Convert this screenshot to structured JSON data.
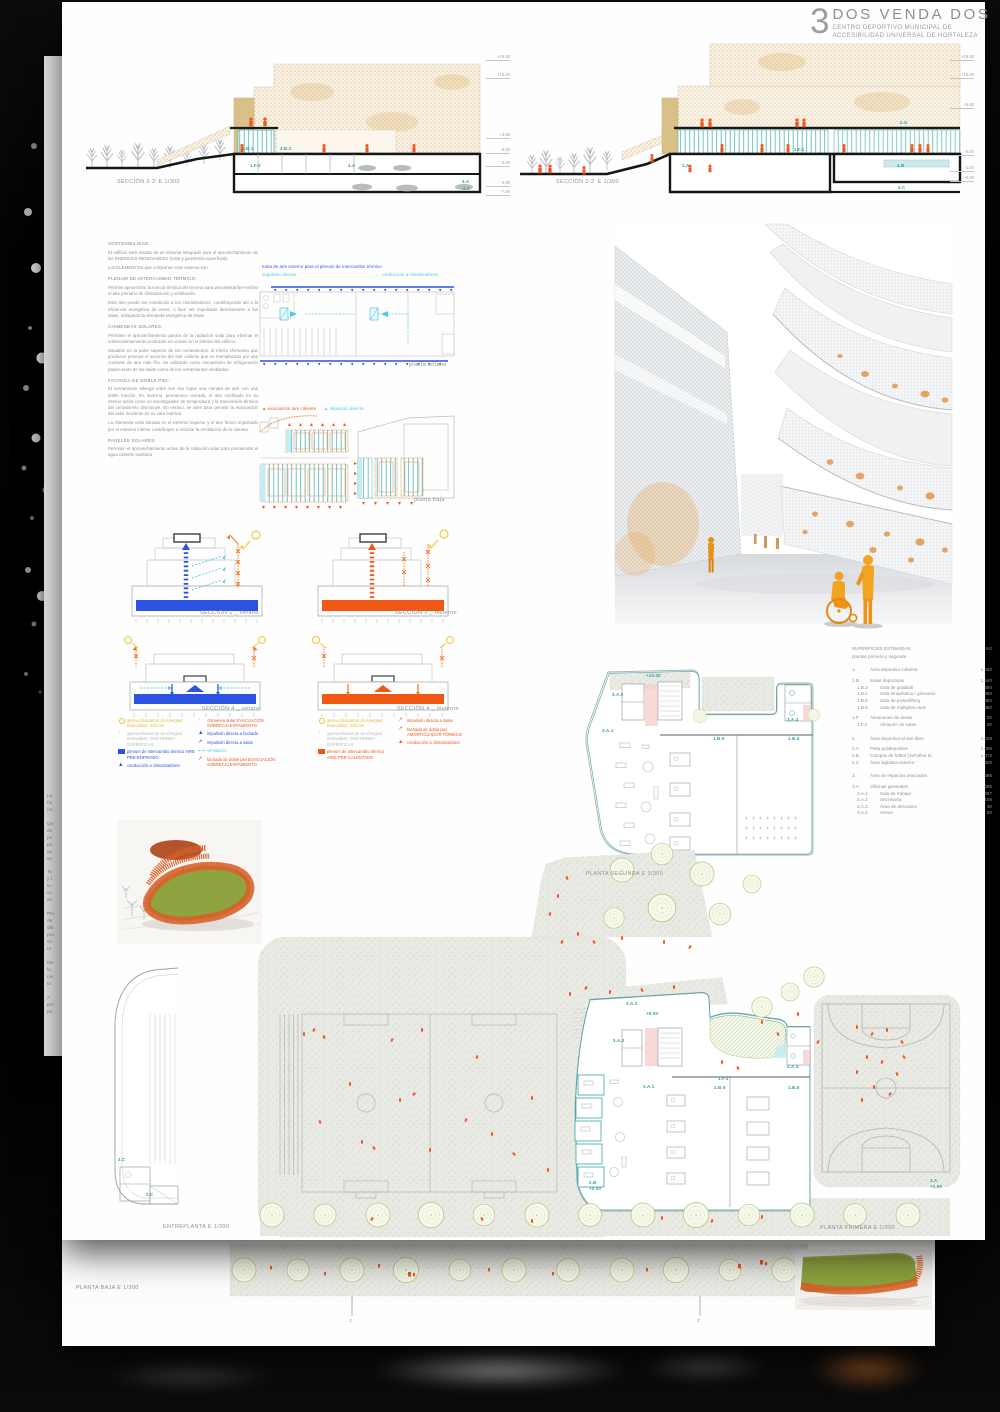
{
  "colors": {
    "teal": "#2f9fa0",
    "orange": "#f0561c",
    "blue": "#2b52e0",
    "cyan": "#4ec9de",
    "yellow": "#f2c230",
    "winter_orange": "#f05714",
    "model_green": "#8da23f",
    "model_orange": "#e0622a"
  },
  "title": {
    "number": "3",
    "name": "DOS VENDA DOS",
    "line1": "CENTRO DEPORTIVO MUNICIPAL DE",
    "line2": "ACCESIBILIDAD UNIVERSAL DE HORTALEZA"
  },
  "top_sections": {
    "left_label": "SECCIÓN 3-3' E 1/300",
    "right_label": "SECCIÓN 2-2' E 1/300",
    "mid_levels": [
      "+19.50",
      "+15.20",
      "+3.50",
      "-0.00",
      "-3.00",
      "-4.00",
      "-7.00"
    ],
    "right_levels": [
      "+19.50",
      "+15.00",
      "+5.60",
      "-0.00",
      "-1.00",
      "-5.00"
    ],
    "tags_left": {
      "b1": "3.B.1",
      "b2": "3.B.2",
      "f3": "1.F.3",
      "a1": "4.A",
      "a2": "4.A",
      "c": "4.C"
    },
    "tags_right": {
      "g": "2.G",
      "f1": "1.F.1",
      "a": "1.A",
      "b": "4.B",
      "c": "4.C"
    }
  },
  "sustainability": {
    "paragraphs": [
      {
        "t": "SOSTENIBILIDAD"
      },
      {
        "t": "El edificio está dotado de un sistema integrado para el aprovechamiento de las ENERGÍAS RENOVABLES (solar y geotermia superficial)."
      },
      {
        "t": "Los ELEMENTOS que componen este sistema son"
      },
      {
        "t": "PLENUM DE INTERCAMBIO TÉRMICO:"
      },
      {
        "t": "Permite aprovechar la inercia térmica del terreno para precalentar/pre-enfriar el aire primario de climatización y ventilación."
      },
      {
        "t": "Este aire puede ser conducido a los climatizadores, contribuyendo así a la eficiencia energética de estos, o bien ser impulsado directamente a las salas, rebajando la demanda energética de éstas."
      },
      {
        "t": "CHIMENEAS SOLARES:"
      },
      {
        "t": "Permiten el aprovechamiento pasivo de la radiación solar para eliminar el sobrecalentamiento producido en verano en el interior del edificio."
      },
      {
        "t": "Situados en la parte superior de los cerramientos, el efecto chimenea que producen provoca el ascenso del aire caliente que es reemplazado por una corriente de aire más fría. Se utilizarán como mecanismo de refrigeración pasiva tanto de las salas como de los cerramientos ventilados."
      },
      {
        "t": "FACHADA DE DOBLE PIEL:"
      },
      {
        "t": "El cerramiento alberga entre sus dos hojas una cámara de aire con una doble función. En invierno, permanece cerrada, el aire confinado en su interior actúa como un amortiguador de temperatura y la transmisión térmica del cerramiento disminuye. En verano, se abre para permitir la evacuación del calor incidente en su cara externa."
      },
      {
        "t": "La chimenea solar situada en el extremo superior y el aire fresco impulsado por el extremo inferior contribuyen a reforzar la ventilación de la cámara."
      },
      {
        "t": "PANELES SOLARES:"
      },
      {
        "t": "Permiten el aprovechamiento activo de la radiación solar para precalentar el agua caliente sanitaria"
      }
    ]
  },
  "plenum_plan": {
    "note_blue": "toma de aire exterior para el plenum de intercambio térmico",
    "note_cyan_left": "impulsión directa",
    "note_cyan_right": "← conducción a climatizadores",
    "label": "planta sótano"
  },
  "baja_plan": {
    "note_orange": "▲ evacuación aire caliente",
    "note_cyan": "▲ impulsión directa",
    "label": "planta baja"
  },
  "mini_sections": {
    "s1v": "SECCIÓN 1 _ verano",
    "s1i": "SECCIÓN 1 _ invierno",
    "s4v": "SECCIÓN 4 _ verano",
    "s4i": "SECCIÓN 4 _ invierno"
  },
  "legends": {
    "summer_a": [
      {
        "icon": "sun",
        "color": "#f2c230",
        "text": "aprovechamiento de energías renovables: SOLAR"
      },
      {
        "icon": "geo-arrow",
        "color": "#b4b8bc",
        "text": "aprovechamiento de energías renovables: GEOTERMIA SUPERFICIAL"
      },
      {
        "icon": "swatch",
        "color": "#2b52e0",
        "text": "plenum de intercambio térmico AIRE PRE-ENFRIADO"
      },
      {
        "icon": "arrow-up",
        "color": "#2b52e0",
        "text": "conducción a climatizadores"
      }
    ],
    "summer_b": [
      {
        "icon": "chimney",
        "color": "#f2a230",
        "text": "chimenea solar EVACUACIÓN SOBRECALENTAMIENTO"
      },
      {
        "icon": "arrow-up",
        "color": "#2b52e0",
        "text": "impulsión directa a fachada"
      },
      {
        "icon": "arrow-diag",
        "color": "#2b52e0",
        "text": "impulsión directa a salas"
      },
      {
        "icon": "dash",
        "color": "#6fd3e6",
        "text": "ventilación"
      },
      {
        "icon": "arrow-diag",
        "color": "#f0561c",
        "text": "fachada de doble piel EVACUACIÓN SOBRECALENTAMIENTO"
      }
    ],
    "winter_a": [
      {
        "icon": "sun",
        "color": "#f2c230",
        "text": "aprovechamiento de energías renovables: SOLAR"
      },
      {
        "icon": "geo-arrow",
        "color": "#b4b8bc",
        "text": "aprovechamiento de energías renovables: GEOTERMIA SUPERFICIAL"
      },
      {
        "icon": "swatch",
        "color": "#f0561c",
        "text": "plenum de intercambio térmico AIRE PRE-CALENTADO"
      }
    ],
    "winter_b": [
      {
        "icon": "arrow-diag",
        "color": "#f0561c",
        "text": "impulsión directa a salas"
      },
      {
        "icon": "arrow-diag",
        "color": "#f0561c",
        "text": "fachada de doble piel AMORTIGUADOR TÉRMICO"
      },
      {
        "icon": "arrow-up",
        "color": "#f0561c",
        "text": "conducción a climatizadores"
      }
    ]
  },
  "areas_table": {
    "title": "SUPERFICIES ESTIMADAS",
    "unit": "m2",
    "subtitle": "plantas primera y segunda",
    "rows": [
      {
        "code": "1.",
        "name": "Área deportiva cubierta",
        "value": "1.440"
      },
      {
        "code": "1.B",
        "name": "Salas deportivas",
        "value": "1.440"
      },
      {
        "code": "1.B.3",
        "name": "Sala de goalball",
        "value": "360"
      },
      {
        "code": "1.B.4",
        "name": "Sala terapéutica / gimnasio",
        "value": "360"
      },
      {
        "code": "1.B.5",
        "name": "Sala de powerlifting",
        "value": "360"
      },
      {
        "code": "1.B.6",
        "name": "Sala de múltiples usos",
        "value": "360"
      },
      {
        "code": "1.F",
        "name": "Almacenes de áreas",
        "value": "20"
      },
      {
        "code": "1.F.3",
        "name": "Almacén de salas",
        "value": "20"
      },
      {
        "code": "2.",
        "name": "Área deportiva al aire libre",
        "value": "3.028"
      },
      {
        "code": "2.A",
        "name": "Pista polideportiva",
        "value": "1.056"
      },
      {
        "code": "2.B",
        "name": "Campos de fútbol (3xFútbol 5)",
        "value": "1.072"
      },
      {
        "code": "2.C",
        "name": "Área logística exterior",
        "value": "900"
      },
      {
        "code": "3.",
        "name": "Área de espacios asociados",
        "value": "695"
      },
      {
        "code": "3.A",
        "name": "Oficinas generales",
        "value": "695"
      },
      {
        "code": "3.A.1",
        "name": "Sala de trabajo",
        "value": "497"
      },
      {
        "code": "3.A.2",
        "name": "Secretaría",
        "value": "108"
      },
      {
        "code": "3.A.3",
        "name": "Área de descanso",
        "value": "30"
      },
      {
        "code": "3.A.4",
        "name": "Aseos",
        "value": "60"
      }
    ]
  },
  "plans": {
    "segunda_label": "PLANTA SEGUNDA E 1/300",
    "entreplanta_label": "ENTREPLANTA E 1/300",
    "primera_label": "PLANTA PRIMERA E 1/300",
    "baja_label": "PLANTA BAJA E 1/300",
    "segunda_tags": {
      "lvl": "+10.00",
      "a2": "3.A.2",
      "a1": "3.A.1",
      "a4": "3.A.4",
      "b5": "1.B.5",
      "b6": "1.B.6"
    },
    "primera_tags": {
      "a3": "3.A.3",
      "lvl": "+5.00",
      "a2": "3.A.2",
      "a1": "3.A.1",
      "a4": "3.A.4",
      "f3": "1.F.3",
      "b5": "1.B.5",
      "b6": "1.B.6"
    },
    "entre_tags": {
      "t1": "2.C",
      "t2": "3.C"
    },
    "court_tags": {
      "field": "2.B\n+0.00",
      "bball": "2.A\n+1.50"
    },
    "ticks": {
      "t1": "1'",
      "t2": "2'"
    }
  },
  "back_sheet": {
    "fragments": "La\nhu\nno\n\nQu\nde\npe\npo\nqu\nse\n\nTo\ny l\nla\ncu\nse\n\nPla\nde\ndib\npro\ncir\nre\n\nDe\nla\nniv\nla\n\nA\npro\npri"
  }
}
